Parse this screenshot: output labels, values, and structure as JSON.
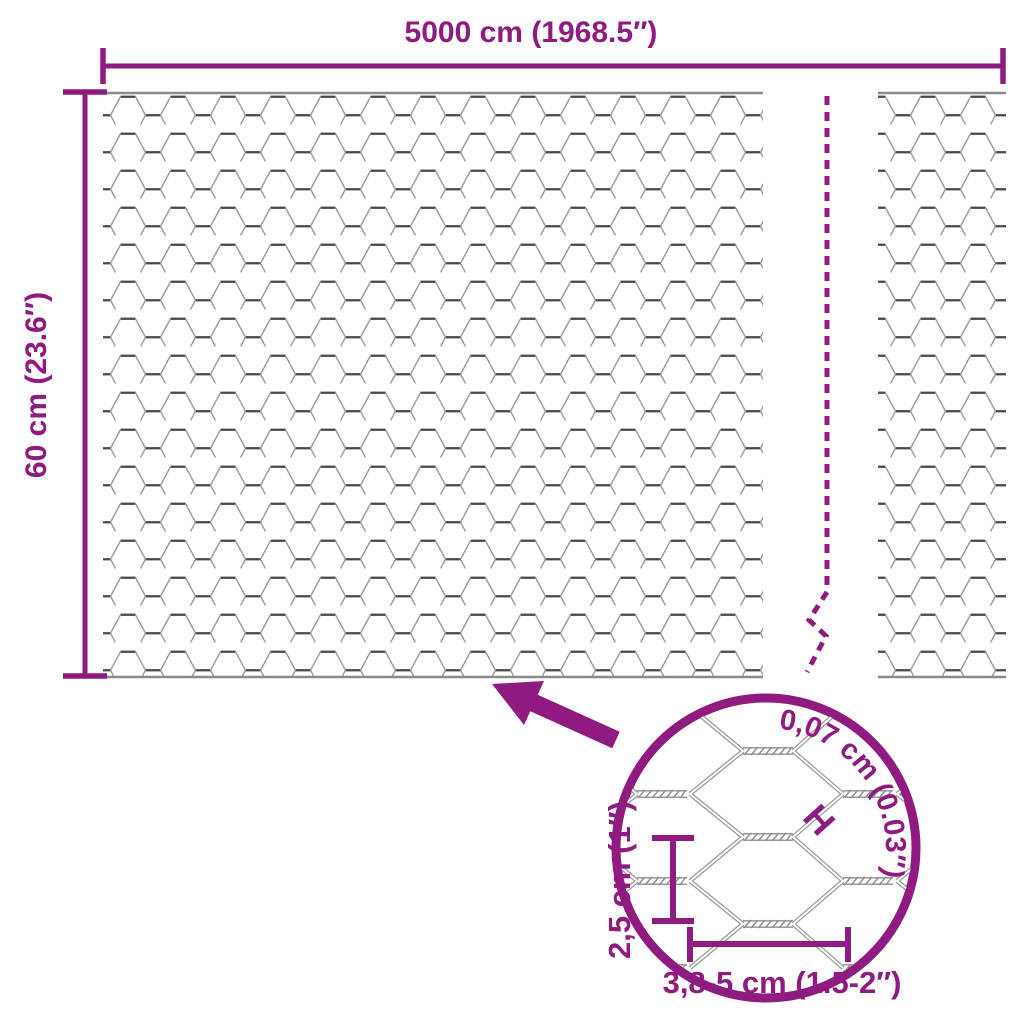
{
  "diagram": {
    "type": "product-dimension-diagram",
    "subject": "hexagonal chicken wire mesh roll",
    "colors": {
      "accent": "#8F1A80",
      "wire_light": "#9B9B9B",
      "wire_dark": "#4A4A4A",
      "background": "#FFFFFF"
    },
    "labels": {
      "total_width": "5000 cm (1968.5″)",
      "total_height": "60 cm (23.6″)",
      "mesh_pitch_vertical": "2,5 cm (1″)",
      "mesh_pitch_horizontal": "3,8-5 cm (1.5-2″)",
      "wire_thickness": "0,07 cm (0.03″)",
      "wire_thickness_marker": "H"
    }
  }
}
